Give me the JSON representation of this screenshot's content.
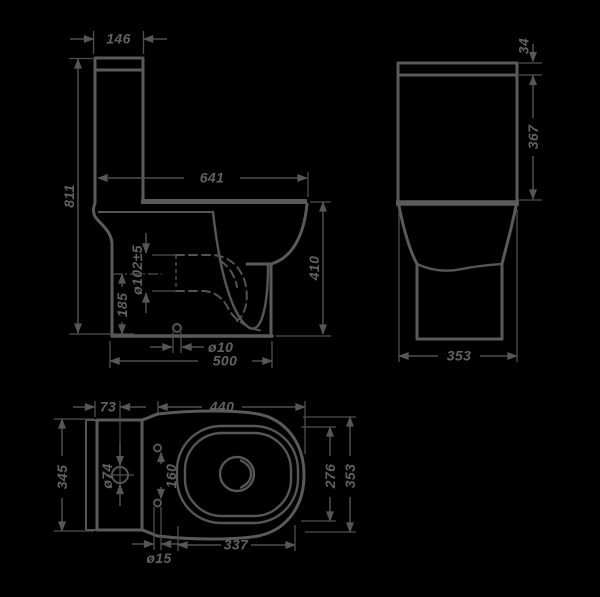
{
  "drawing_type": "toilet-technical-dimension-drawing",
  "colors": {
    "background": "#000000",
    "line": "#5a5a5a",
    "dimension_line": "#4f4f4f",
    "text": "#616161"
  },
  "views": {
    "side": {
      "name": "side-view",
      "dimensions": {
        "tank_depth": "146",
        "total_height": "811",
        "total_depth": "641",
        "outlet_diameter": "ø102±5",
        "outlet_height": "185",
        "rim_height": "410",
        "fixing_hole": "ø10",
        "base_depth": "500"
      }
    },
    "front": {
      "name": "front-view",
      "dimensions": {
        "lid_height": "34",
        "cistern_height": "367",
        "width": "353"
      }
    },
    "plan": {
      "name": "plan-view",
      "dimensions": {
        "inlet_offset": "73",
        "bowl_length": "440",
        "rear_width": "345",
        "inlet_diameter": "ø74",
        "seat_hole_spacing": "160",
        "rim_width": "276",
        "overall_width": "353",
        "seat_hole_diameter": "ø15",
        "rim_length": "337"
      }
    }
  }
}
